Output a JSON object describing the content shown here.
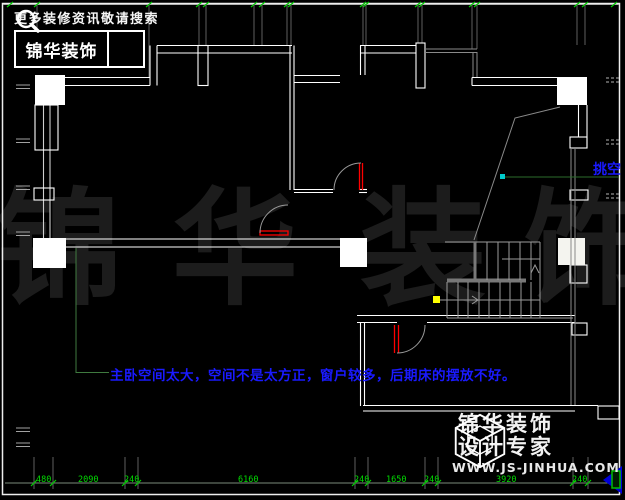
{
  "header": {
    "tagline": "更多装修资讯敬请搜索",
    "brand": "锦华装饰"
  },
  "watermark": {
    "char1": "锦",
    "char2": "华",
    "char3": "装",
    "char4": "饰"
  },
  "plan": {
    "note": "主卧空间太大，空间不是太方正，窗户较多，后期床的摆放不好。",
    "void_label": "挑空"
  },
  "dimensions": {
    "bottom": [
      "480",
      "2090",
      "240",
      "6160",
      "240",
      "1650",
      "240",
      "3920",
      "240"
    ]
  },
  "footer": {
    "brand_line1": "锦华装饰",
    "brand_line2": "设计专家",
    "website": "WWW.JS-JINHUA.COM"
  },
  "colors": {
    "annotation_blue": "#1a1aff",
    "dimension_green": "#00dd00",
    "leader_green": "#3f7a3f",
    "door_red": "#ff0000",
    "marker_yellow": "#ffff00",
    "marker_cyan": "#00cccc",
    "nav_arrow_blue": "#0000d8",
    "watermark_gray": "#1c1c1c"
  }
}
